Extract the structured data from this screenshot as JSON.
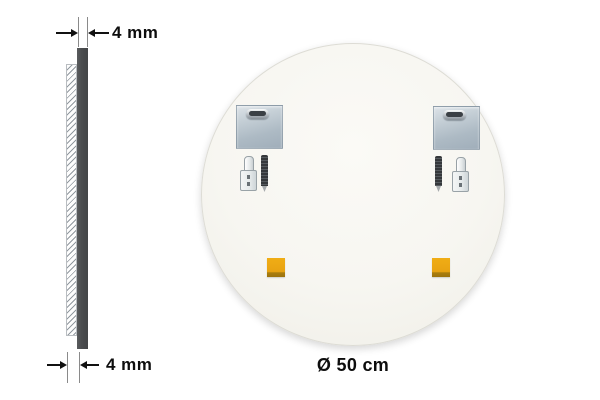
{
  "annotations": {
    "thickness_top": "4 mm",
    "thickness_bottom": "4 mm",
    "diameter": "Ø 50 cm"
  },
  "icons": {
    "cross_section_hatch": "cross-section-hatch",
    "mirror_edge": "mirror-edge-bar",
    "mounting_plate": "mounting-plate-icon",
    "keyhole_slot": "keyhole-slot-icon",
    "screw": "screw-icon",
    "wall_plug": "wall-plug-icon",
    "adhesive_pad": "adhesive-pad-icon"
  },
  "colors": {
    "background": "#ffffff",
    "mirror_back": "#f8f7f2",
    "glass_edge_bar": "#4b4d4f",
    "plate_steel": "#b4c0ca",
    "adhesive_pad": "#e8a312",
    "annotation_text": "#111111"
  }
}
